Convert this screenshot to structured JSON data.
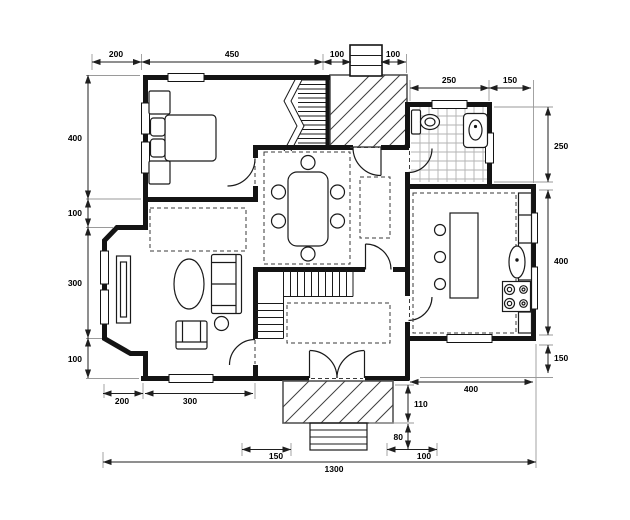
{
  "colors": {
    "wall": "#141414",
    "dimension_line": "#1f1f1f",
    "extension_line": "#9a9a9a"
  },
  "dimensions": {
    "top": [
      "200",
      "450",
      "100",
      "100"
    ],
    "bath_top": [
      "250",
      "150"
    ],
    "right": [
      "250",
      "400",
      "150"
    ],
    "left": [
      "400",
      "100",
      "300",
      "100"
    ],
    "bottom_left": [
      "200",
      "300"
    ],
    "bottom_right": [
      "400"
    ],
    "porch_right": [
      "110",
      "80"
    ],
    "steps_bottom": [
      "150",
      "100"
    ],
    "total_width": "1300"
  }
}
